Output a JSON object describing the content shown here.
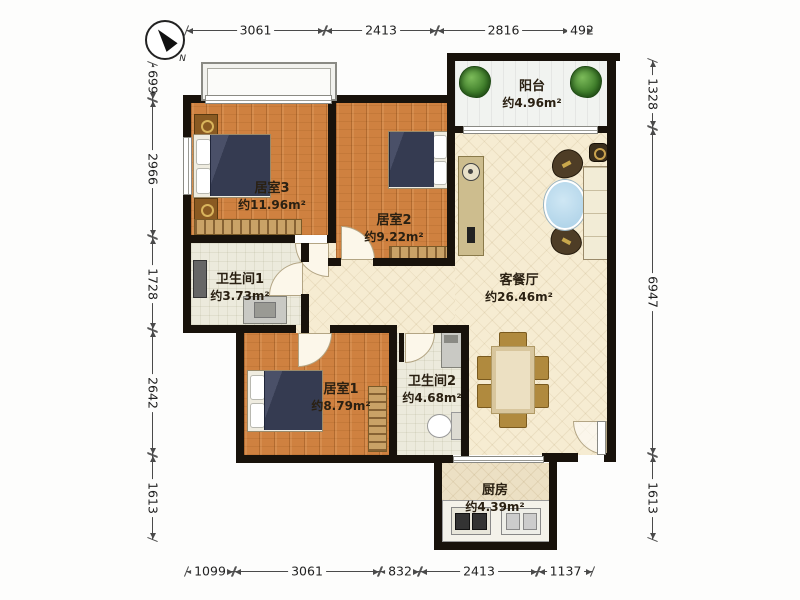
{
  "compass": {
    "label": "N"
  },
  "dimensions": {
    "top": [
      "3061",
      "2413",
      "2816",
      "492"
    ],
    "bottom": [
      "1099",
      "3061",
      "832",
      "2413",
      "1137"
    ],
    "left": [
      "699",
      "2966",
      "1728",
      "2642",
      "1613"
    ],
    "right": [
      "1328",
      "6947",
      "1613"
    ]
  },
  "rooms": {
    "bedroom3": {
      "name": "居室3",
      "area": "约11.96m²"
    },
    "bedroom2": {
      "name": "居室2",
      "area": "约9.22m²"
    },
    "bedroom1": {
      "name": "居室1",
      "area": "约8.79m²"
    },
    "living_dining": {
      "name": "客餐厅",
      "area": "约26.46m²"
    },
    "bathroom1": {
      "name": "卫生间1",
      "area": "约3.73m²"
    },
    "bathroom2": {
      "name": "卫生间2",
      "area": "约4.68m²"
    },
    "balcony": {
      "name": "阳台",
      "area": "约4.96m²"
    },
    "kitchen": {
      "name": "厨房",
      "area": "约4.39m²"
    }
  },
  "colors": {
    "wall": "#18120b",
    "wood_floor": "#cf8140",
    "hall_floor": "#f6ecd2",
    "bath_floor": "#eceadc",
    "balcony_floor": "#f1f3f0",
    "bed_blanket": "#363c52",
    "coffee_table": "#b9d9ec",
    "dining_chair": "#b08a3e",
    "plant": "#3e7d2a"
  }
}
